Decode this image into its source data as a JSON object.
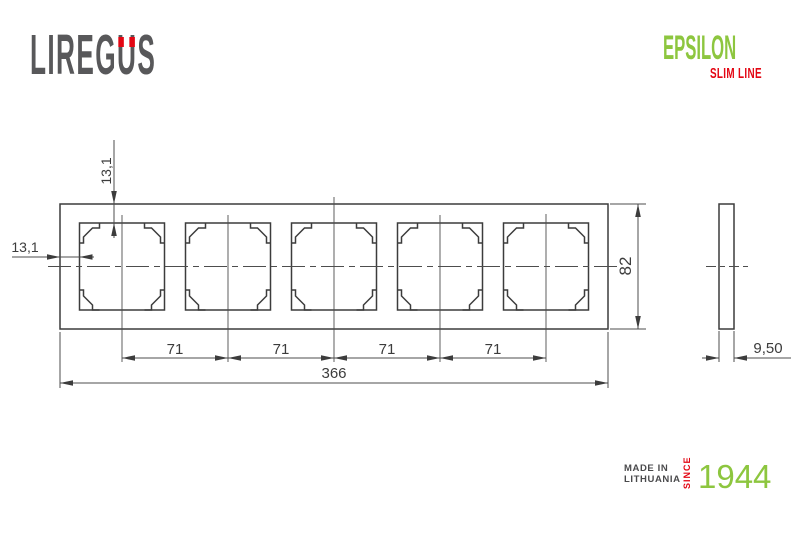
{
  "header": {
    "logo": {
      "part1": "LIREG",
      "letter_u": "U",
      "part2": "S"
    },
    "product": {
      "name": "EPSILON",
      "line": "SLIM LINE"
    }
  },
  "drawing": {
    "title": "5-gang frame technical drawing, front and side view",
    "dims": {
      "offset_top": "13,1",
      "offset_left": "13,1",
      "height": "82",
      "pitch": "71",
      "total_width": "366",
      "thickness": "9,50"
    }
  },
  "footer": {
    "made_in_line1": "MADE IN",
    "made_in_line2": "LITHUANIA",
    "since_label": "SINCE",
    "year": "1944"
  },
  "colors": {
    "brand_green": "#8dc63f",
    "brand_red": "#e30613",
    "logo_gray": "#58585a",
    "line_color": "#3c3c3c"
  }
}
